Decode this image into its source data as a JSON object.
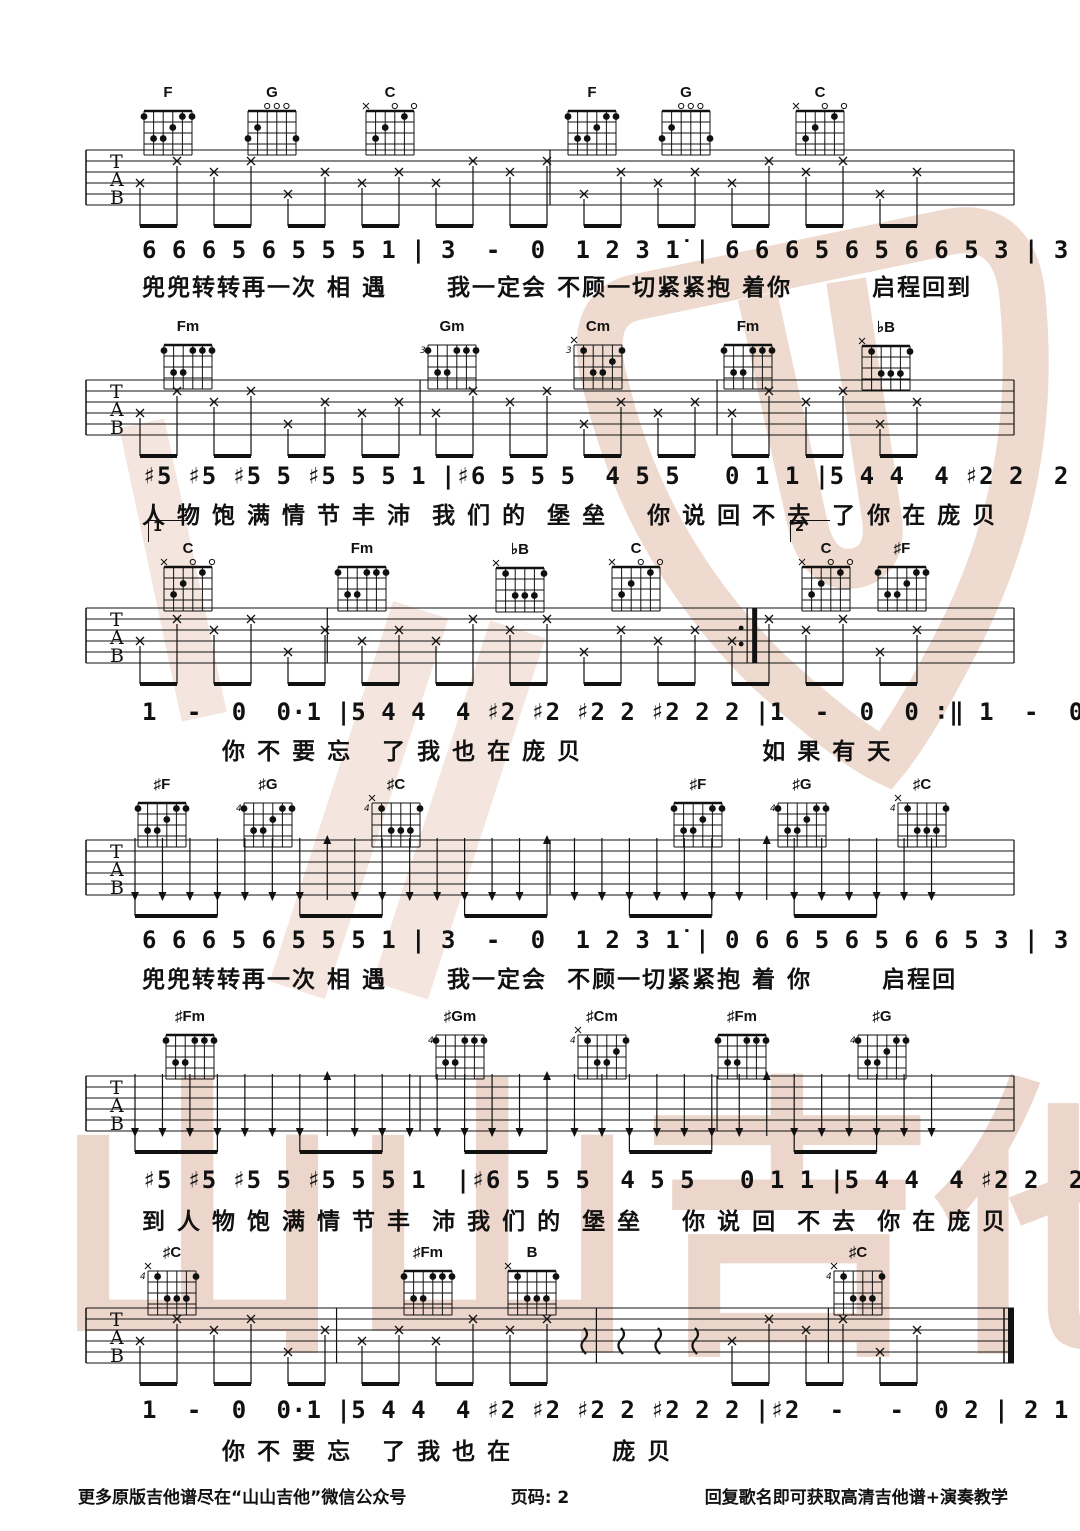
{
  "page": {
    "footer_left": "更多原版吉他谱尽在“山山吉他”微信公众号",
    "footer_center": "页码: 2",
    "footer_right": "回复歌名即可获取高清吉他谱+演奏教学"
  },
  "watermark": {
    "text": "山山吉他",
    "color": "#d9a892",
    "light": "#eed6c8"
  },
  "ink_color": "#111111",
  "chord_shapes": {
    "F": {
      "mute": [],
      "open": [],
      "dots": [
        [
          0,
          1
        ],
        [
          4,
          1
        ],
        [
          5,
          1
        ],
        [
          3,
          2
        ],
        [
          1,
          3
        ],
        [
          2,
          3
        ]
      ]
    },
    "G": {
      "mute": [],
      "open": [
        2,
        3,
        4
      ],
      "dots": [
        [
          1,
          2
        ],
        [
          0,
          3
        ],
        [
          5,
          3
        ]
      ]
    },
    "C": {
      "mute": [
        0
      ],
      "open": [
        3,
        5
      ],
      "dots": [
        [
          4,
          1
        ],
        [
          2,
          2
        ],
        [
          1,
          3
        ]
      ]
    },
    "Fm": {
      "mute": [],
      "open": [],
      "dots": [
        [
          0,
          1
        ],
        [
          3,
          1
        ],
        [
          4,
          1
        ],
        [
          5,
          1
        ],
        [
          1,
          3
        ],
        [
          2,
          3
        ]
      ]
    },
    "Cm": {
      "mute": [
        0
      ],
      "open": [],
      "dots": [
        [
          1,
          1
        ],
        [
          5,
          1
        ],
        [
          4,
          2
        ],
        [
          2,
          3
        ],
        [
          3,
          3
        ]
      ]
    },
    "bB": {
      "mute": [
        0
      ],
      "open": [],
      "dots": [
        [
          1,
          1
        ],
        [
          5,
          1
        ],
        [
          2,
          3
        ],
        [
          3,
          3
        ],
        [
          4,
          3
        ]
      ]
    },
    "B": {
      "mute": [
        0
      ],
      "open": [],
      "dots": [
        [
          1,
          1
        ],
        [
          5,
          1
        ],
        [
          2,
          3
        ],
        [
          3,
          3
        ],
        [
          4,
          3
        ]
      ]
    }
  },
  "systems": [
    {
      "tab_style": "picking",
      "bars": [
        {
          "f": 0.5
        }
      ],
      "chords": [
        {
          "name": "F",
          "x": 168,
          "base": "",
          "shape": "F"
        },
        {
          "name": "G",
          "x": 272,
          "base": "",
          "shape": "G"
        },
        {
          "name": "C",
          "x": 390,
          "base": "",
          "shape": "C"
        },
        {
          "name": "F",
          "x": 592,
          "base": "",
          "shape": "F"
        },
        {
          "name": "G",
          "x": 686,
          "base": "",
          "shape": "G"
        },
        {
          "name": "C",
          "x": 820,
          "base": "",
          "shape": "C"
        }
      ],
      "melody": "6 6 6 5 6 5 5 5 1 | 3  -  0  1 2 3 1̇ | 6 6 6 5 6 5 6 6 5 3 | 3  -  0  1 2 3 1̇ |",
      "lyrics": "兜兜转转再一次 相 遇      我一定会 不顾一切紧紧抱 着你        启程回到"
    },
    {
      "tab_style": "picking",
      "bars": [
        {
          "f": 0.36
        },
        {
          "f": 0.68
        }
      ],
      "chords": [
        {
          "name": "Fm",
          "x": 188,
          "base": "",
          "shape": "Fm"
        },
        {
          "name": "Gm",
          "x": 452,
          "base": "3",
          "shape": "Fm"
        },
        {
          "name": "Cm",
          "x": 598,
          "base": "3",
          "shape": "Cm"
        },
        {
          "name": "Fm",
          "x": 748,
          "base": "",
          "shape": "Fm"
        },
        {
          "name": "♭B",
          "x": 886,
          "base": "",
          "shape": "bB"
        }
      ],
      "melody": "♯5 ♯5 ♯5 5 ♯5 5 5 1 |♯6 5 5 5  4 5 5   0 1 1 |5 4 4  4 ♯2 2  2 ♯2 2 2",
      "lyrics": "人 物 饱 满 情 节 丰 沛  我 们 的  堡 垒    你 说 回 不 去  了 你 在 庞 贝"
    },
    {
      "tab_style": "picking",
      "bars": [
        {
          "f": 0.26
        },
        {
          "f": 0.72,
          "type": "repeat"
        }
      ],
      "voltas": [
        {
          "label": "1",
          "x": 148
        },
        {
          "label": "2",
          "x": 790
        }
      ],
      "chords": [
        {
          "name": "C",
          "x": 188,
          "base": "",
          "shape": "C"
        },
        {
          "name": "Fm",
          "x": 362,
          "base": "",
          "shape": "Fm"
        },
        {
          "name": "♭B",
          "x": 520,
          "base": "",
          "shape": "bB"
        },
        {
          "name": "C",
          "x": 636,
          "base": "",
          "shape": "C"
        },
        {
          "name": "C",
          "x": 826,
          "base": "",
          "shape": "C"
        },
        {
          "name": "♯F",
          "x": 902,
          "base": "",
          "shape": "F"
        }
      ],
      "melody": "1  -  0  0·1 |5 4 4  4 ♯2 ♯2 ♯2 2 ♯2 2 2 |1  -  0  0 ∶‖ 1  -  0  1 2 3 1̇|",
      "lyrics": "        你 不 要 忘   了 我 也 在 庞 贝                  如 果 有 天"
    },
    {
      "tab_style": "strum",
      "bars": [
        {
          "f": 0.5
        }
      ],
      "chords": [
        {
          "name": "♯F",
          "x": 162,
          "base": "",
          "shape": "F"
        },
        {
          "name": "♯G",
          "x": 268,
          "base": "4",
          "shape": "F"
        },
        {
          "name": "♯C",
          "x": 396,
          "base": "4",
          "shape": "bB"
        },
        {
          "name": "♯F",
          "x": 698,
          "base": "",
          "shape": "F"
        },
        {
          "name": "♯G",
          "x": 802,
          "base": "4",
          "shape": "F"
        },
        {
          "name": "♯C",
          "x": 922,
          "base": "4",
          "shape": "bB"
        }
      ],
      "melody": "6 6 6 5 6 5 5 5 1 | 3  -  0  1 2 3 1̇ | 0 6 6 5 6 5 6 6 5 3 | 3  -  0  1 2 3 1̇ |",
      "lyrics": "兜兜转转再一次 相 遇      我一定会  不顾一切紧紧抱 着 你       启程回"
    },
    {
      "tab_style": "strum",
      "bars": [
        {
          "f": 0.36
        },
        {
          "f": 0.68
        }
      ],
      "chords": [
        {
          "name": "♯Fm",
          "x": 190,
          "base": "",
          "shape": "Fm"
        },
        {
          "name": "♯Gm",
          "x": 460,
          "base": "4",
          "shape": "Fm"
        },
        {
          "name": "♯Cm",
          "x": 602,
          "base": "4",
          "shape": "Cm"
        },
        {
          "name": "♯Fm",
          "x": 742,
          "base": "",
          "shape": "Fm"
        },
        {
          "name": "♯G",
          "x": 882,
          "base": "4",
          "shape": "F"
        }
      ],
      "melody": "♯5 ♯5 ♯5 5 ♯5 5 5 1  |♯6 5 5 5  4 5 5   0 1 1 |5 4 4  4 ♯2 2  2 ♯2 2 2 |",
      "lyrics": "到 人 物 饱 满 情 节 丰  沛 我 们 的  堡 垒    你 说 回  不 去  你 在 庞 贝"
    },
    {
      "tab_style": "mixed",
      "bars": [
        {
          "f": 0.27
        },
        {
          "f": 0.55
        },
        {
          "f": 0.8
        }
      ],
      "final_bar": true,
      "chords": [
        {
          "name": "♯C",
          "x": 172,
          "base": "4",
          "shape": "bB"
        },
        {
          "name": "♯Fm",
          "x": 428,
          "base": "",
          "shape": "Fm"
        },
        {
          "name": "B",
          "x": 532,
          "base": "",
          "shape": "B"
        },
        {
          "name": "♯C",
          "x": 858,
          "base": "4",
          "shape": "bB"
        }
      ],
      "melody": "1  -  0  0·1 |5 4 4  4 ♯2 ♯2 ♯2 2 ♯2 2 2 |♯2  -   -  0 2 | 2 1 1  -  0 ‖",
      "lyrics": "        你 不 要 忘   了 我 也 在          庞 贝"
    }
  ]
}
